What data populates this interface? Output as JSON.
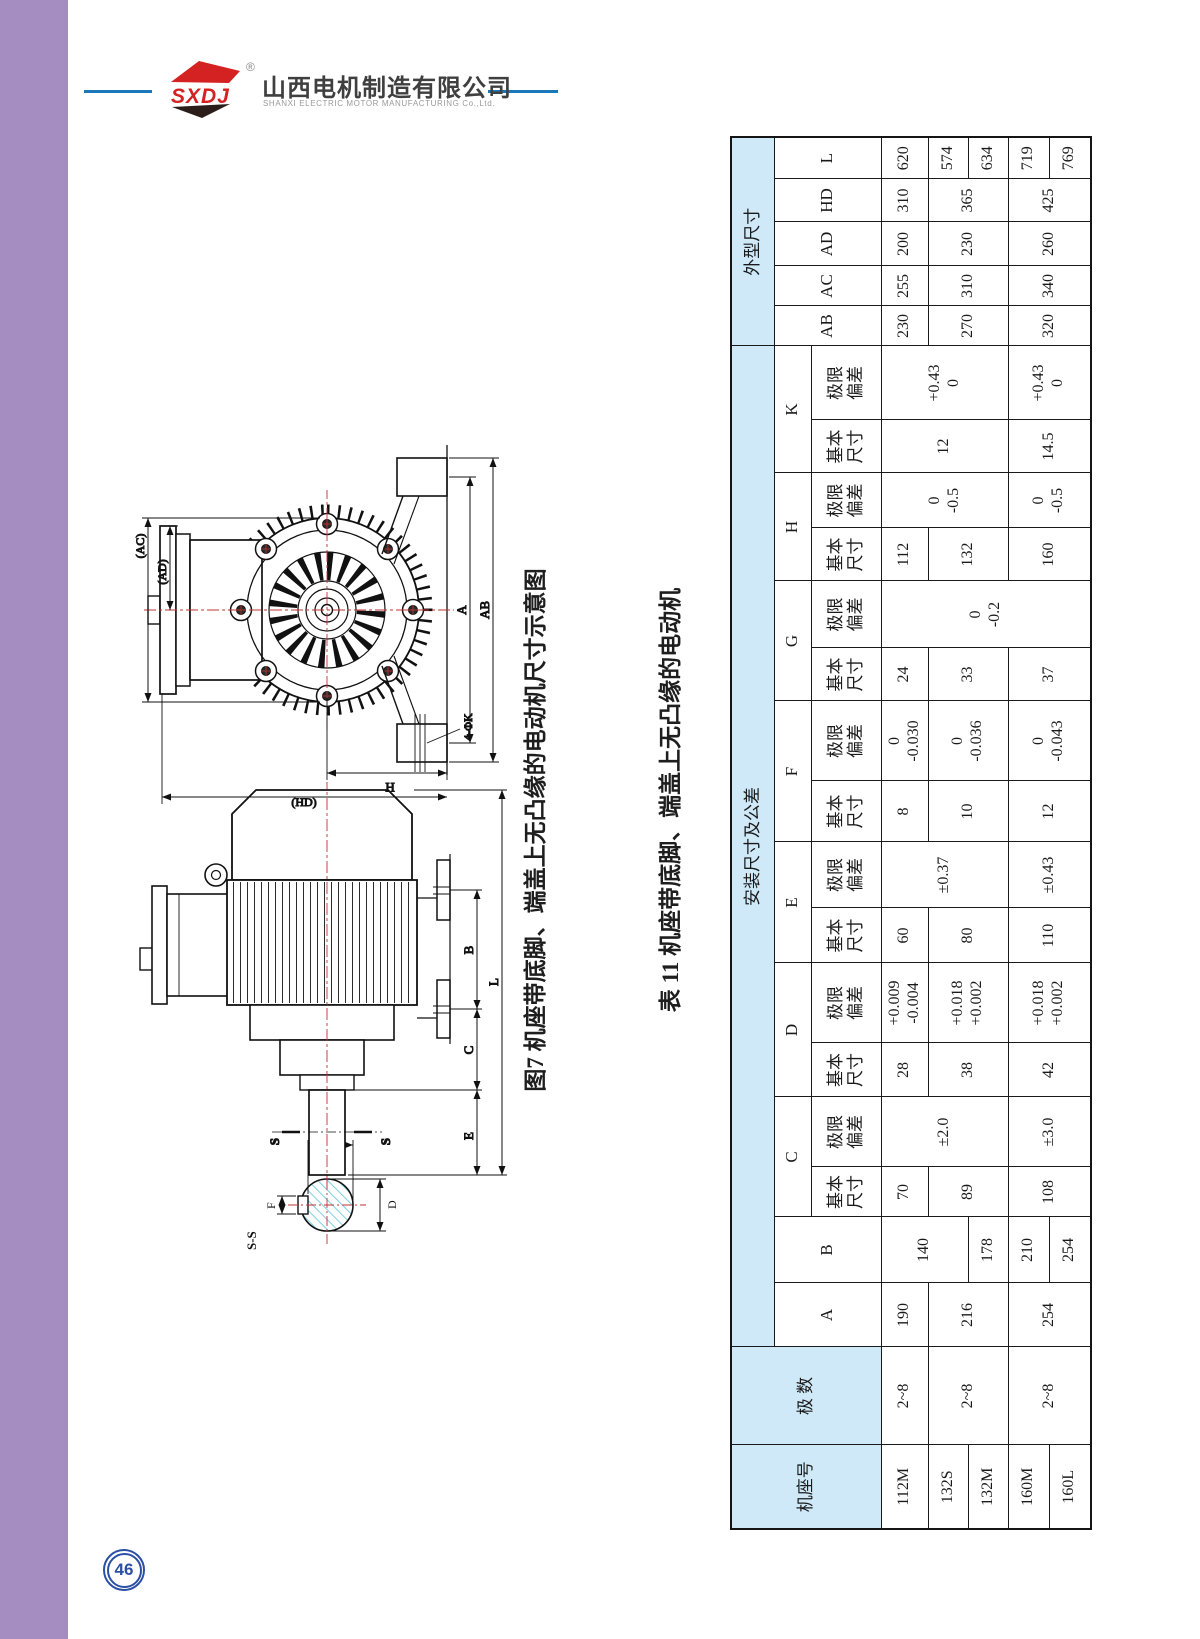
{
  "header": {
    "logo_text": "SXDJ",
    "registered": "®",
    "company_cn": "山西电机制造有限公司",
    "company_en": "SHANXI ELECTRIC MOTOR MANUFACTURING Co.,Ltd."
  },
  "page_number": "46",
  "figure": {
    "caption": "图7 机座带底脚、端盖上无凸缘的电动机尺寸示意图",
    "labels": {
      "section_title": "S-S",
      "s_mark": "S",
      "f": "F",
      "g": "G",
      "d": "D",
      "e": "E",
      "c": "C",
      "b": "B",
      "l": "L",
      "ac": "(AC)",
      "ad": "(AD)",
      "hd": "(HD)",
      "h": "H",
      "a": "A",
      "ab": "AB",
      "k_holes": "4-ΦK"
    }
  },
  "table": {
    "title": "表 11 机座带底脚、端盖上无凸缘的电动机",
    "headers": {
      "frame": "机座号",
      "poles": "极 数",
      "mounting_group": "安装尺寸及公差",
      "overall_group": "外型尺寸",
      "basic": "基本\n尺寸",
      "tolerance": "极限\n偏差",
      "a": "A",
      "b": "B",
      "c": "C",
      "d": "D",
      "e": "E",
      "f": "F",
      "g": "G",
      "h": "H",
      "k": "K",
      "ab": "AB",
      "ac": "AC",
      "ad": "AD",
      "hd": "HD",
      "l": "L"
    },
    "values": {
      "r112M": {
        "frame": "112M",
        "poles": "2~8",
        "A": "190",
        "B": "140",
        "C": "70",
        "C_tol": "±2.0",
        "D": "28",
        "D_tol": "+0.009\n-0.004",
        "E": "60",
        "E_tol": "±0.37",
        "F": "8",
        "F_tol": "0\n-0.030",
        "G": "24",
        "G_tol": "0\n-0.2",
        "H": "112",
        "H_tol": "0\n-0.5",
        "K": "12",
        "K_tol": "+0.43\n0",
        "AB": "230",
        "AC": "255",
        "AD": "200",
        "HD": "310",
        "L": "620"
      },
      "r132S": {
        "frame": "132S",
        "poles": "2~8",
        "A": "216",
        "C": "89",
        "D": "38",
        "D_tol": "+0.018\n+0.002",
        "E": "80",
        "F": "10",
        "F_tol": "0\n-0.036",
        "G": "33",
        "H": "132",
        "AB": "270",
        "AC": "310",
        "AD": "230",
        "HD": "365",
        "L": "574"
      },
      "r132M": {
        "frame": "132M",
        "B": "178",
        "L": "634"
      },
      "r160M": {
        "frame": "160M",
        "poles": "2~8",
        "A": "254",
        "B": "210",
        "C": "108",
        "C_tol": "±3.0",
        "D": "42",
        "D_tol": "+0.018\n+0.002",
        "E": "110",
        "E_tol": "±0.43",
        "F": "12",
        "F_tol": "0\n-0.043",
        "G": "37",
        "H": "160",
        "H_tol": "0\n-0.5",
        "K": "14.5",
        "K_tol": "+0.43\n0",
        "AB": "320",
        "AC": "340",
        "AD": "260",
        "HD": "425",
        "L": "719"
      },
      "r160L": {
        "frame": "160L",
        "B": "254",
        "L": "769"
      }
    }
  }
}
